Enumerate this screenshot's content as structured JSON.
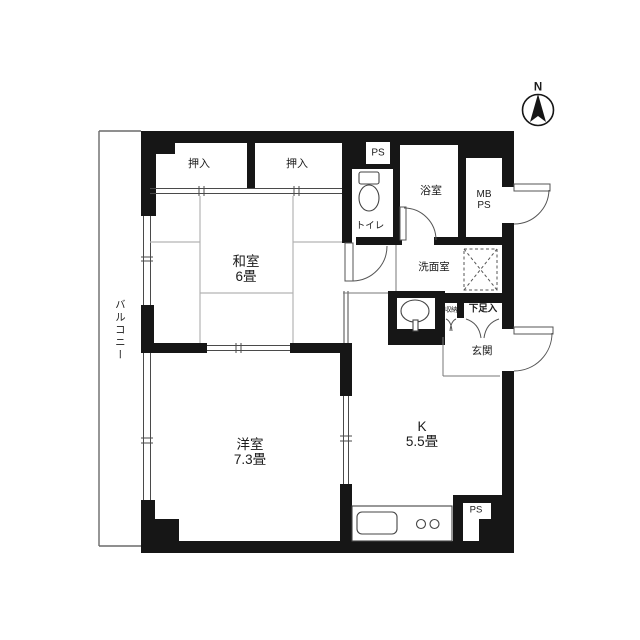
{
  "plan_title": "1DK apartment floor plan",
  "compass": {
    "north": "N"
  },
  "balcony": {
    "label": "バルコニー"
  },
  "rooms": {
    "washitsu": {
      "name": "和室",
      "size": "6畳"
    },
    "western": {
      "name": "洋室",
      "size": "7.3畳"
    },
    "kitchen": {
      "name": "K",
      "size": "5.5畳"
    },
    "bath": {
      "name": "浴室"
    },
    "toilet": {
      "name": "トイレ"
    },
    "washroom": {
      "name": "洗面室"
    },
    "entrance": {
      "name": "玄関"
    }
  },
  "storage": {
    "closet_left": "押入",
    "closet_right": "押入",
    "storage_small": "収納",
    "shoe_box": "下足入"
  },
  "shafts": {
    "ps_top": "PS",
    "mb_line1": "MB",
    "mb_line2": "PS",
    "ps_bottom": "PS"
  },
  "colors": {
    "wall": "#161616",
    "line": "#555555",
    "tatami": "#b3b3b3"
  }
}
